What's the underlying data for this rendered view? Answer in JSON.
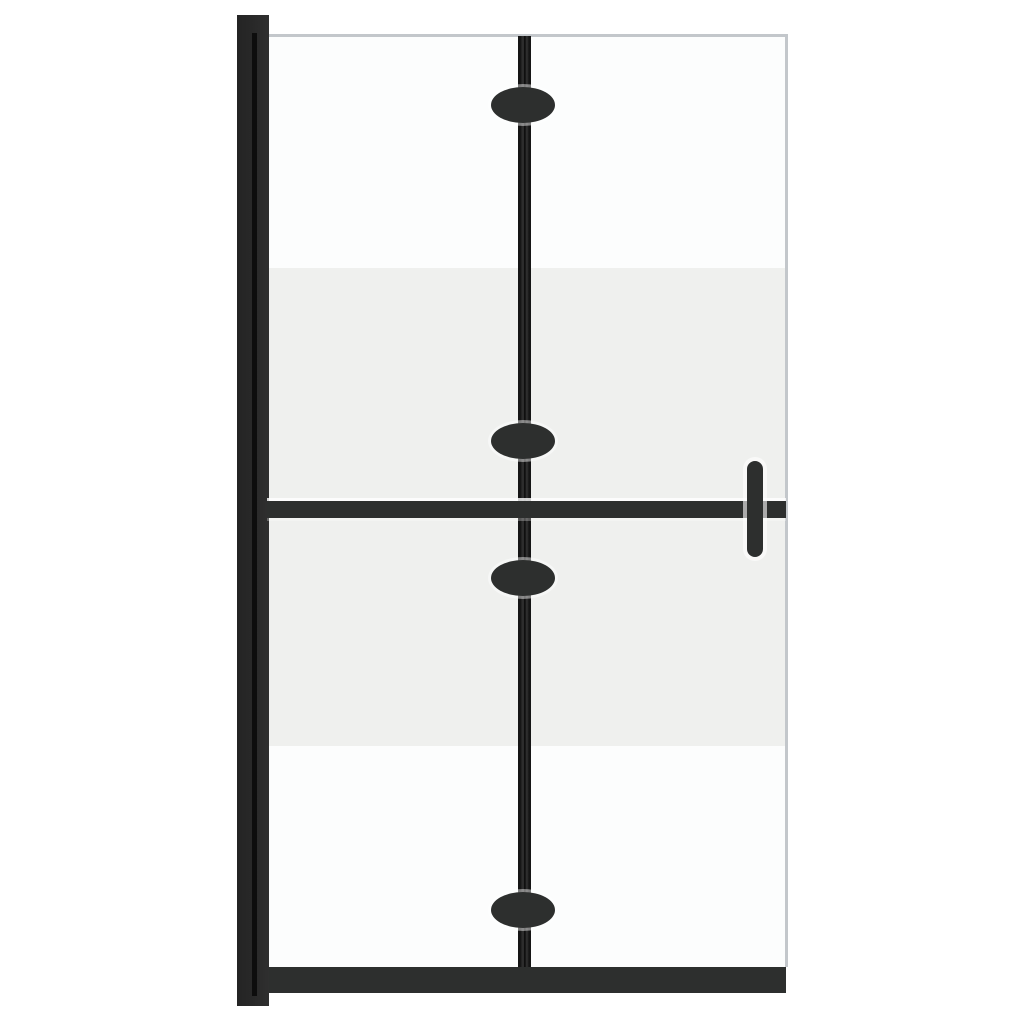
{
  "image": {
    "type": "product-photo",
    "subject": "Foldable walk-in shower screen with half-frosted glass and black frame",
    "visible_text": ""
  },
  "colors": {
    "background": "#ffffff",
    "frame": "#2d2f2e",
    "rail-dark": "#151515",
    "wall-profile": "#282828",
    "wall-groove": "#0d0d0d",
    "frosted-glass": "#eff0ee",
    "clear-glass": "#fcfdfd",
    "glass-edge": "#c3c7cb",
    "halo": "rgba(255,255,255,0.6)"
  },
  "parts": {
    "wall_profile": "wall mounting profile",
    "wall_groove": "profile seam groove",
    "glass_panel": "clear glass panel",
    "glass_top_edge": "glass top edge",
    "glass_right_edge": "glass right edge",
    "frosted_band": "frosted privacy band",
    "fold_rail": "center folding hinge rail",
    "crossbar": "horizontal support bar",
    "bottom_rail": "bottom frame rail",
    "hinge_knobs": [
      "top hinge knob",
      "upper middle hinge knob",
      "lower middle hinge knob",
      "bottom hinge knob"
    ],
    "handle": "support handle"
  }
}
